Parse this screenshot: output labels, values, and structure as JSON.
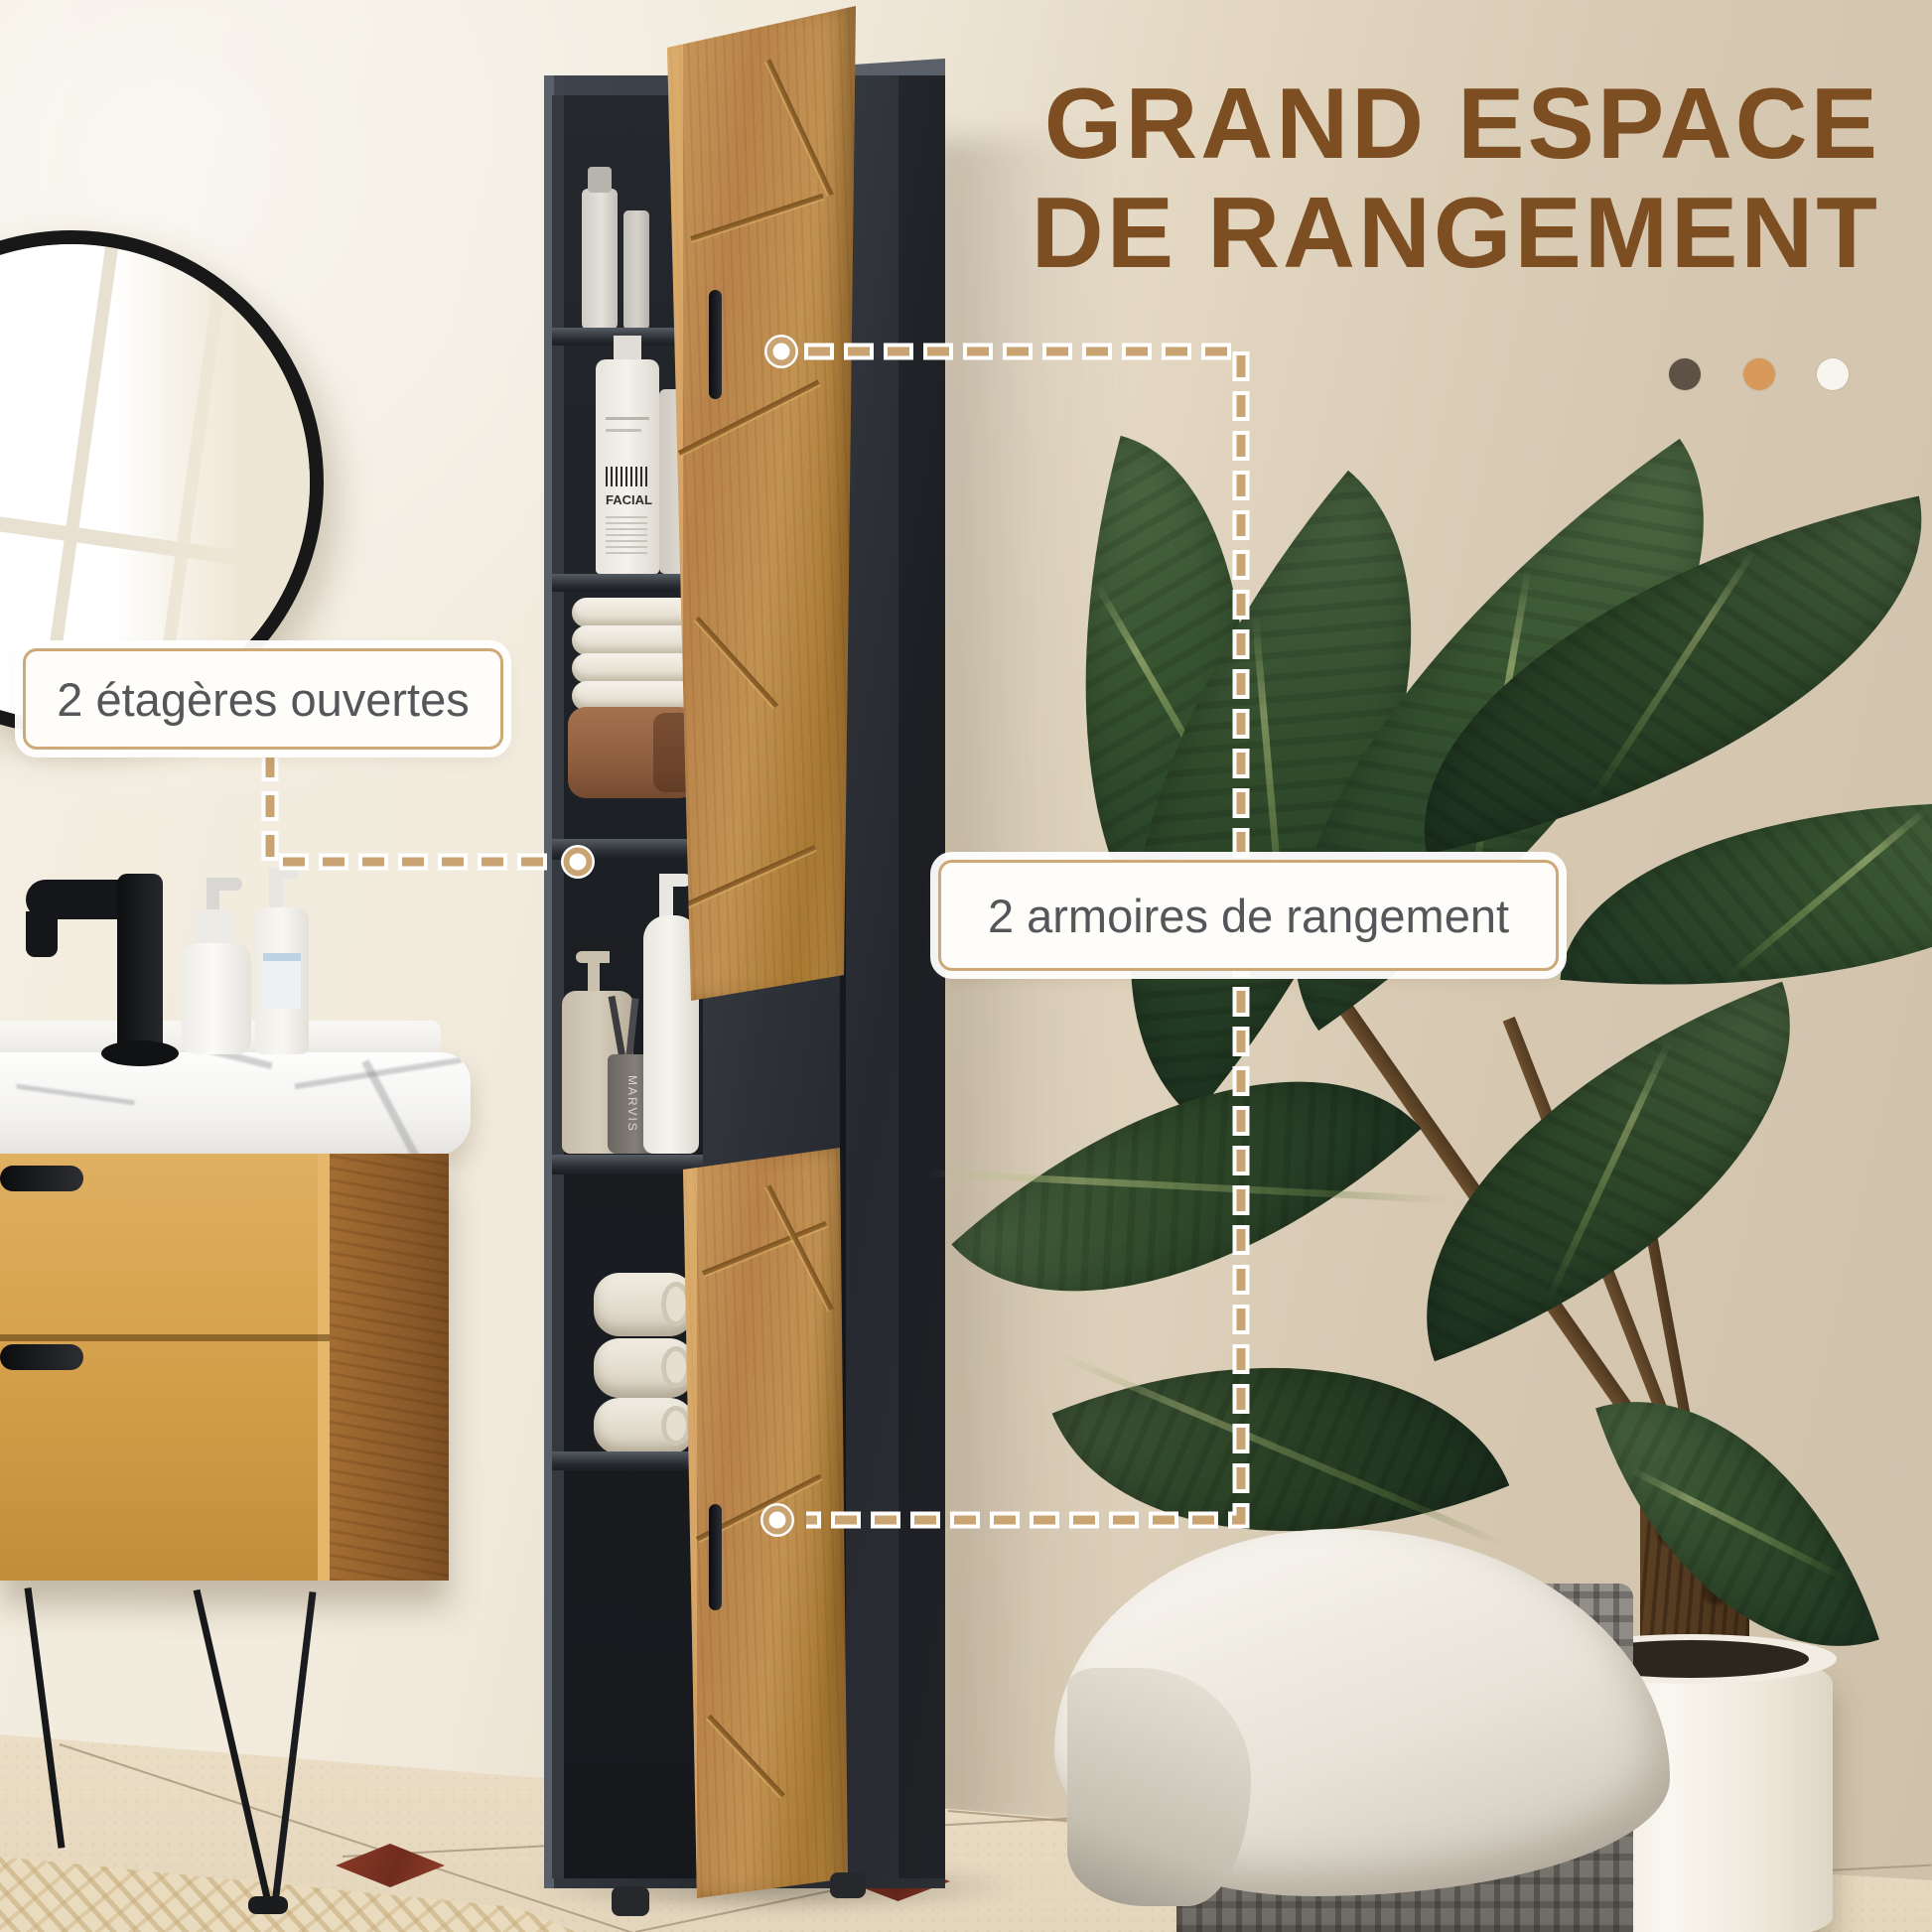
{
  "page": {
    "type": "product-feature-photo",
    "language": "fr",
    "subject": "colonne de salle de bain grise et bois"
  },
  "headline": {
    "line1": "GRAND ESPACE",
    "line2": "DE RANGEMENT",
    "color": "#7d4e22"
  },
  "palette_dots": {
    "items": [
      {
        "name": "dot-dark-brown",
        "color": "#5e5247"
      },
      {
        "name": "dot-orange",
        "color": "#d6995a"
      },
      {
        "name": "dot-white",
        "color": "#f8f5ef"
      }
    ]
  },
  "callouts": {
    "open_shelves": "2 étagères ouvertes",
    "cabinets": "2 armoires de rangement",
    "line_color": "#c9a472"
  },
  "scene_text": {
    "facial_bottle": "FACIAL",
    "toothbrush_cup": "MARVIS"
  }
}
